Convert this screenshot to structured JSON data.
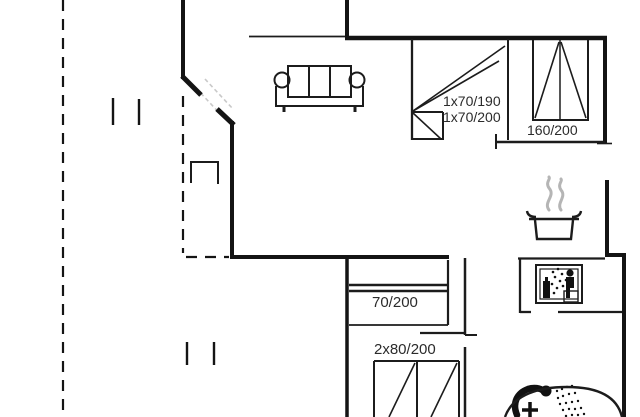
{
  "plan": {
    "type": "floor-plan",
    "beds": {
      "bunk_upper": "1x70/190",
      "bunk_lower": "1x70/200",
      "double": "160/200",
      "single": "70/200",
      "twin": "2x80/200"
    },
    "icons": [
      "sofa-icon",
      "porch-table-icon",
      "cooking-pot-icon",
      "steam-icon",
      "sauna-icon",
      "shower-icon",
      "bathtub-icon",
      "entrance-door-icon"
    ],
    "colors": {
      "wall": "#141414",
      "interior_wall": "#1c1c1c",
      "text": "#2b2b2b",
      "steam": "#b5b5b5",
      "door_leaf": "#c9c9c9",
      "background": "#ffffff"
    }
  }
}
